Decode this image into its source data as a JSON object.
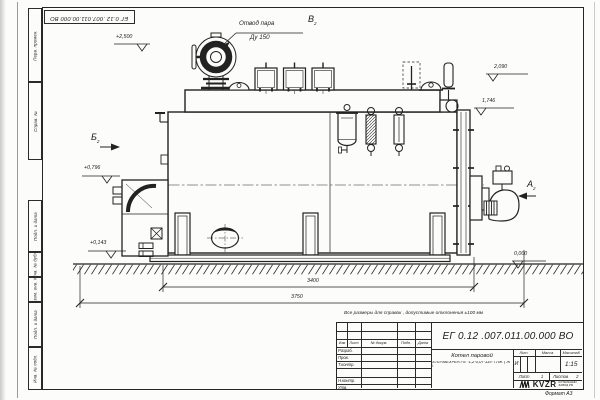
{
  "sheet": {
    "format_label": "Формат А3",
    "top_stamp": "ЕГ 0.12 .007.011.00.000  ВО",
    "margin_cells": [
      "Перв. примен.",
      "Справ. №",
      "Подп. и дата",
      "Инв. № дубл.",
      "Взам. инв. №",
      "Подп. и дата",
      "Инв. № подл."
    ]
  },
  "drawing": {
    "callout": {
      "line1": "Отвод пара",
      "line2": "Ду 150"
    },
    "views": {
      "b": "Б",
      "v": "В",
      "a": "А",
      "sheet_ref": "2"
    },
    "elevations": {
      "top": "+2,500",
      "right_upper": "2,090",
      "right_lower": "1,746",
      "left_upper": "+0,796",
      "left_lower": "+0,143",
      "ground": "0,000"
    },
    "dimensions": {
      "inner": "3400",
      "overall": "3750"
    },
    "note": "Все размеры для справок , допустимые отклонения ±100 мм"
  },
  "title_block": {
    "doc_number": "ЕГ 0.12 .007.011.00.000  ВО",
    "cols": {
      "izm": "Изм",
      "list": "Лист",
      "doc": "№ докум.",
      "sign": "Подп.",
      "date": "Дата"
    },
    "rows": {
      "developed": "Разраб.",
      "checked": "Пров.",
      "tcontrol": "Т.контр.",
      "ncontrol": "Н.контр.",
      "approved": "Утв."
    },
    "product": {
      "line1": "Котел паровой",
      "line2": "STEAMEXPERT-Е -1,2-0,07-115- ГЛЖ ( Ж )"
    },
    "lit": {
      "label": "Лит.",
      "value": "И"
    },
    "mass": {
      "label": "Масса"
    },
    "scale": {
      "label": "Масштаб",
      "value": "1:15"
    },
    "sheet": {
      "label": "Лист",
      "value": "1"
    },
    "sheets": {
      "label": "Листов",
      "value": "2"
    },
    "brand": {
      "name": "KVZR",
      "line1": "КОТЕЛЬНЫЙ",
      "line2": "ЗАВОД РФ"
    }
  }
}
